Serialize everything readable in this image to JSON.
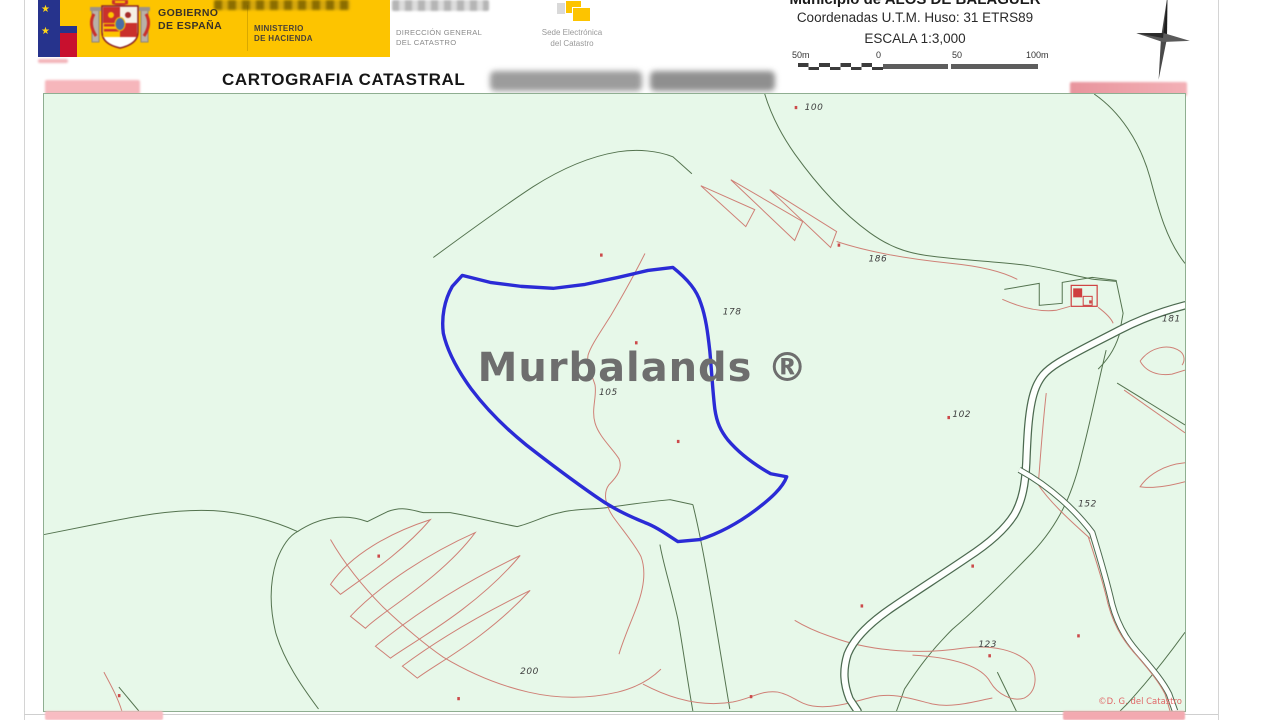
{
  "header": {
    "gobierno": [
      "GOBIERNO",
      "DE ESPAÑA"
    ],
    "ministerio": [
      "MINISTERIO",
      "DE HACIENDA"
    ],
    "direccion": [
      "DIRECCIÓN GENERAL",
      "DEL CATASTRO"
    ],
    "sede": [
      "Sede Electrónica",
      "del Catastro"
    ],
    "municipio": "Municipio de ALOS DE BALAGUER",
    "coordenadas": "Coordenadas U.T.M. Huso: 31 ETRS89",
    "escala": "ESCALA 1:3,000",
    "scalebar_labels": [
      "50m",
      "0",
      "50",
      "100m"
    ]
  },
  "title": "CARTOGRAFIA CATASTRAL",
  "map": {
    "watermark": "Murbalands ®",
    "copyright": "©D. G. del Catastro",
    "colors": {
      "background": "#e7f8e9",
      "parcel_boundary": "#54734f",
      "inner_subparcel_line": "#cf8076",
      "selected_parcel": "#2b2bd6",
      "watermark_gray": "#6e6e6e"
    },
    "parcel_labels": [
      {
        "text": "100",
        "x": 762,
        "y": 16
      },
      {
        "text": "178",
        "x": 680,
        "y": 221
      },
      {
        "text": "105",
        "x": 556,
        "y": 302
      },
      {
        "text": "186",
        "x": 826,
        "y": 168
      },
      {
        "text": "102",
        "x": 910,
        "y": 324
      },
      {
        "text": "181",
        "x": 1120,
        "y": 228
      },
      {
        "text": "152",
        "x": 1036,
        "y": 414
      },
      {
        "text": "123",
        "x": 936,
        "y": 555
      },
      {
        "text": "200",
        "x": 477,
        "y": 582
      }
    ],
    "subparcel_marks": [
      {
        "x": 557,
        "y": 160
      },
      {
        "x": 592,
        "y": 248
      },
      {
        "x": 634,
        "y": 347
      },
      {
        "x": 752,
        "y": 12
      },
      {
        "x": 795,
        "y": 150
      },
      {
        "x": 905,
        "y": 323
      },
      {
        "x": 929,
        "y": 472
      },
      {
        "x": 818,
        "y": 512
      },
      {
        "x": 334,
        "y": 462
      },
      {
        "x": 414,
        "y": 605
      },
      {
        "x": 707,
        "y": 603
      },
      {
        "x": 1035,
        "y": 542
      },
      {
        "x": 74,
        "y": 602
      },
      {
        "x": 946,
        "y": 562
      },
      {
        "x": 1047,
        "y": 207
      }
    ]
  }
}
